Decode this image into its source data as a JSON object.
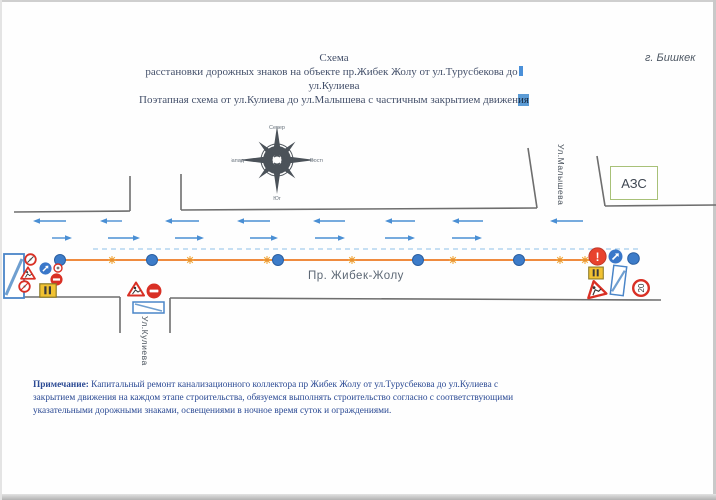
{
  "document": {
    "city_label": "г. Бишкек",
    "title_line1": "Схема",
    "title_line2": "расстановки дорожных знаков на объекте пр.Жибек Жолу от ул.Турусбекова до",
    "title_line3": "ул.Кулиева",
    "title_line4_a": "Поэтапная схема от ул.Кулиева до ул.Малышева с частичным закрытием движен",
    "title_line4_b": "ия",
    "note_label": "Примечание:",
    "note_text": " Капитальный ремонт канализационного коллектора пр Жибек Жолу от ул.Турусбекова до ул.Кулиева с закрытием движения на каждом этапе строительства, обязуемся выполнять строительство согласно  с соответствующими указательными дорожными знаками, освещениями в ночное время суток и ограждениями."
  },
  "compass": {
    "north": "Север",
    "south": "Юг",
    "west": "Запад",
    "east": "Восток"
  },
  "road": {
    "name": "Пр. Жибек-Жолу",
    "cross_street_bottom": "Ул.Кулиева",
    "cross_street_top": "Ул.Малышева",
    "gas_station_label": "АЗС",
    "edge_lines": [
      [
        14,
        212,
        130,
        211
      ],
      [
        130,
        211,
        130,
        176
      ],
      [
        181,
        174,
        181,
        210
      ],
      [
        181,
        210,
        537,
        208
      ],
      [
        537,
        208,
        528,
        148
      ],
      [
        605,
        206,
        597,
        156
      ],
      [
        605,
        206,
        716,
        205
      ],
      [
        8,
        297,
        120,
        297
      ],
      [
        120,
        297,
        120,
        333
      ],
      [
        170,
        298,
        170,
        333
      ],
      [
        170,
        298,
        661,
        300
      ]
    ],
    "dashed_divider": {
      "x1": 93,
      "y": 249,
      "x2": 638
    },
    "barrier_line": {
      "x1": 60,
      "y": 260,
      "x2": 594
    },
    "arrows_westbound": {
      "y": 221,
      "spans": [
        [
          33,
          66
        ],
        [
          100,
          122
        ],
        [
          165,
          199
        ],
        [
          237,
          270
        ],
        [
          313,
          345
        ],
        [
          385,
          415
        ],
        [
          452,
          483
        ],
        [
          550,
          583
        ]
      ]
    },
    "arrows_eastbound": {
      "y": 238,
      "spans": [
        [
          52,
          72
        ],
        [
          108,
          140
        ],
        [
          175,
          204
        ],
        [
          250,
          278
        ],
        [
          315,
          345
        ],
        [
          385,
          415
        ],
        [
          452,
          482
        ]
      ]
    },
    "posts_x": [
      60,
      152,
      278,
      418,
      519
    ],
    "posts_y": 260,
    "lamps_x": [
      112,
      190,
      267,
      352,
      453,
      560,
      585
    ],
    "lamps_y": 260
  },
  "signs": {
    "speed_limit": "20",
    "other_danger": "!"
  },
  "colors": {
    "arrow_blue": "#4a8fd4",
    "divider_blue": "#8ec0e8",
    "barrier_orange": "#ef8b3f",
    "post_blue": "#3d7cc9",
    "post_blue_dark": "#2a5ea0",
    "lamp_yellow": "#f2a93c",
    "lamp_core": "#e8912e",
    "road_line_gray": "#6e6e6e",
    "sign_red": "#d93025",
    "sign_blue": "#3a77c9",
    "panel_yellow": "#f1c232",
    "note_navy": "#2b4a94",
    "barrier_panel_blue": "#4a85c8"
  }
}
